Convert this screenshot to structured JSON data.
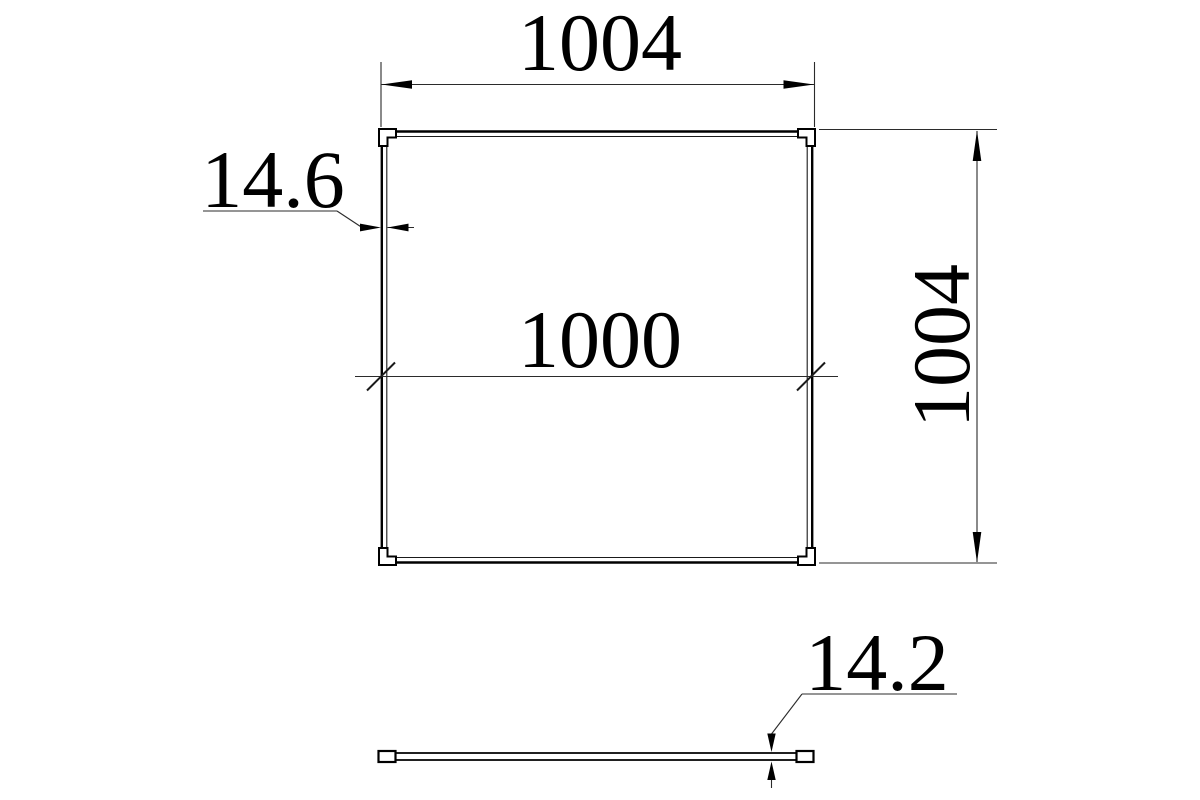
{
  "page": {
    "background_color": "#ffffff",
    "line_color": "#000000"
  },
  "drawing": {
    "kind": "technical-dimension-drawing",
    "views": {
      "front": {
        "name": "panel front view",
        "shape": "square frame with corner keys",
        "dimensions": {
          "outer_width": {
            "label": "1004"
          },
          "outer_height": {
            "label": "1004"
          },
          "frame_face_width": {
            "label": "14.6"
          },
          "inner_width": {
            "label": "1000"
          }
        }
      },
      "profile": {
        "name": "panel edge profile view",
        "shape": "thin strip with end caps",
        "dimensions": {
          "thickness": {
            "label": "14.2"
          }
        }
      }
    }
  }
}
